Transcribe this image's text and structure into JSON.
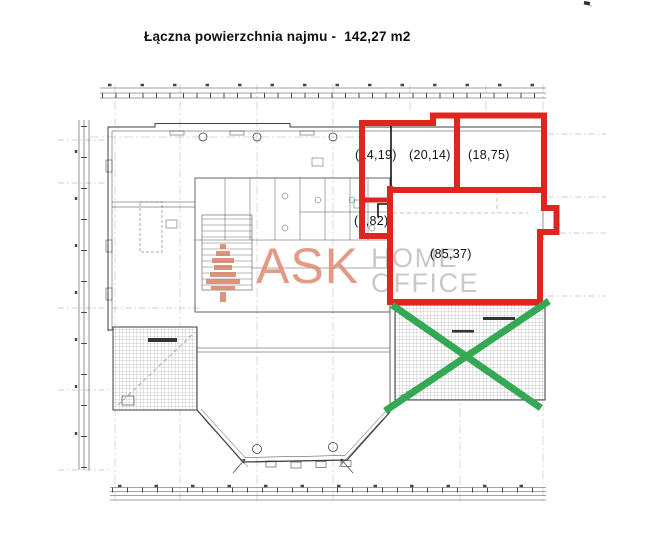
{
  "title": {
    "label": "Łączna powierzchnia najmu -",
    "value": "142,27 m2"
  },
  "watermark": {
    "logo_icon": "ask-tree-logo",
    "word_primary": "ASK",
    "word_secondary_top": "HOME",
    "word_secondary_bottom": "OFFICE"
  },
  "plan": {
    "room_areas": [
      {
        "name": "room-top-left",
        "area_label": "(14,19)"
      },
      {
        "name": "room-top-middle",
        "area_label": "(20,14)"
      },
      {
        "name": "room-top-right",
        "area_label": "(18,75)"
      },
      {
        "name": "room-small",
        "area_label": "(3,82)"
      },
      {
        "name": "room-large",
        "area_label": "(85,37)"
      }
    ]
  },
  "colors": {
    "rental_outline_red": "#e02420",
    "excluded_cross_green": "#34a853",
    "watermark_salmon": "#e08a72",
    "watermark_gray": "#c8c8c8",
    "drawing_ink": "#3f3f3f"
  }
}
